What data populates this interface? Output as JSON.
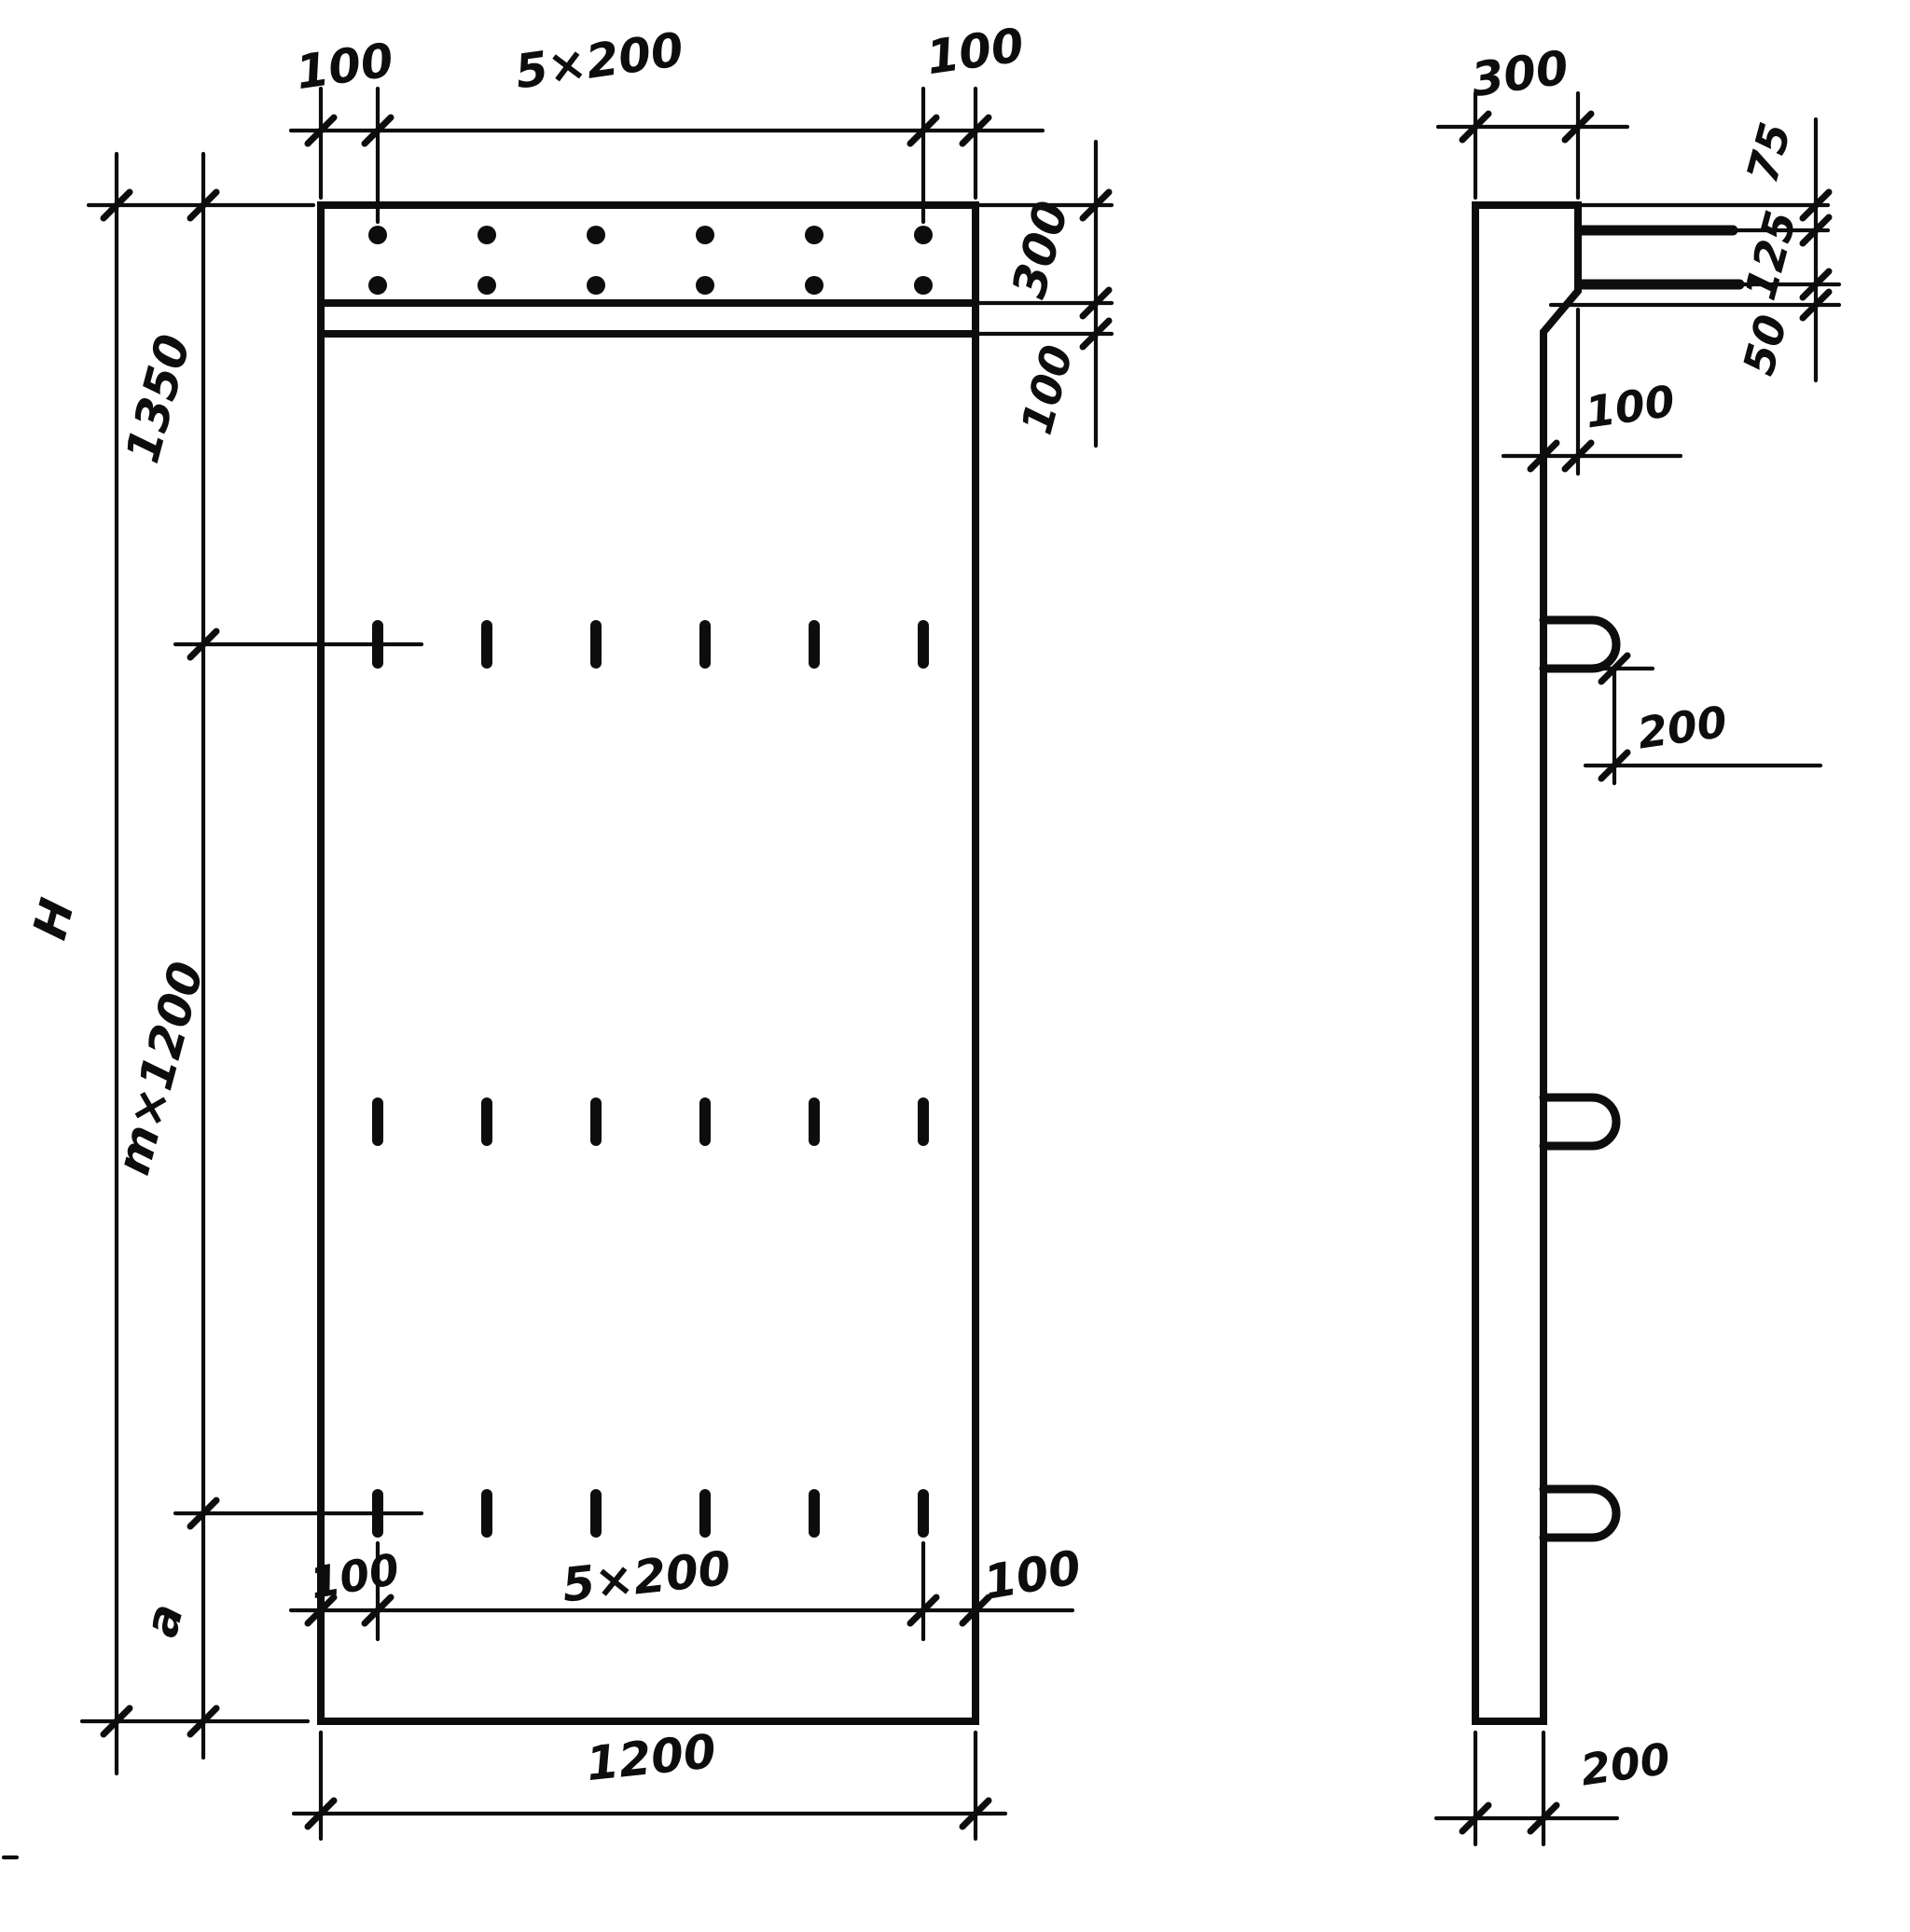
{
  "drawing": {
    "front_view": {
      "top_chain": {
        "left": "100",
        "middle": "5×200",
        "right": "100"
      },
      "right_chain": {
        "ledge_height": "300",
        "gap": "100"
      },
      "left_chain": {
        "overall_height": "H",
        "upper": "1350",
        "middle": "m×1200",
        "lower": "a"
      },
      "bottom_chain": {
        "left": "100",
        "middle": "5×200",
        "right": "100",
        "overall_width": "1200"
      }
    },
    "side_view": {
      "top_width": "300",
      "right_chain": {
        "top": "75",
        "middle": "125",
        "bottom": "50"
      },
      "ledge_depth": "100",
      "loop_offset": "200",
      "bottom_width": "200"
    }
  }
}
